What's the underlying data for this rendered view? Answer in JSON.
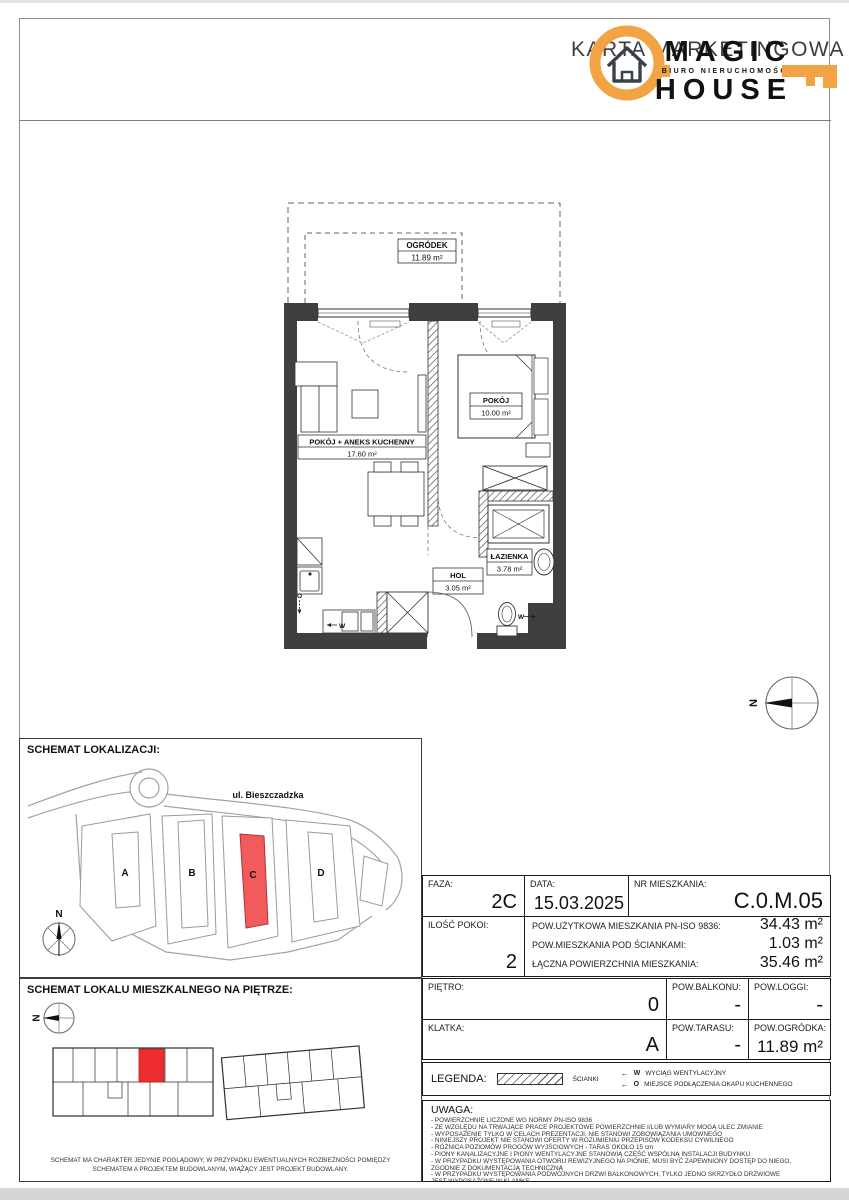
{
  "header": {
    "title": "KARTA MARKETINGOWA",
    "logo": {
      "magic": "MAGIC",
      "house": "HOUSE",
      "tagline": "BIURO NIERUCHOMOŚCI"
    }
  },
  "floorplan": {
    "garden": {
      "name": "OGRÓDEK",
      "area": "11.89 m²"
    },
    "living": {
      "name": "POKÓJ + ANEKS KUCHENNY",
      "area": "17.60 m²"
    },
    "bedroom": {
      "name": "POKÓJ",
      "area": "10.00 m²"
    },
    "hall": {
      "name": "HOL",
      "area": "3.05 m²"
    },
    "bathroom": {
      "name": "ŁAZIENKA",
      "area": "3.78 m²"
    },
    "markers": {
      "vent": "W",
      "hood": "O"
    },
    "compass": "N"
  },
  "location_schematic": {
    "title": "SCHEMAT LOKALIZACJI:",
    "street": "ul. Bieszczadzka",
    "buildings": [
      "A",
      "B",
      "C",
      "D"
    ],
    "highlighted": "C",
    "compass": "N"
  },
  "floor_schematic": {
    "title": "SCHEMAT LOKALU MIESZKALNEGO NA PIĘTRZE:",
    "compass": "N",
    "caption1": "SCHEMAT MA CHARAKTER JEDYNIE POGLĄDOWY, W PRZYPADKU EWENTUALNYCH ROZBIEŻNOŚCI POMIĘDZY",
    "caption2": "SCHEMATEM A PROJEKTEM BUDOWLANYM, WIĄŻĄCY JEST PROJEKT BUDOWLANY."
  },
  "details": {
    "faza": {
      "label": "FAZA:",
      "value": "2C"
    },
    "data": {
      "label": "DATA:",
      "value": "15.03.2025"
    },
    "nr": {
      "label": "NR MIESZKANIA:",
      "value": "C.0.M.05"
    },
    "rooms": {
      "label": "ILOŚĆ POKOI:",
      "value": "2"
    },
    "areas": [
      {
        "label": "POW.UŻYTKOWA MIESZKANIA PN-ISO 9836:",
        "value": "34.43 m²"
      },
      {
        "label": "POW.MIESZKANIA POD ŚCIANKAMI:",
        "value": "1.03 m²"
      },
      {
        "label": "ŁĄCZNA POWIERZCHNIA MIESZKANIA:",
        "value": "35.46 m²"
      }
    ],
    "pietro": {
      "label": "PIĘTRO:",
      "value": "0"
    },
    "balkon": {
      "label": "POW.BALKONU:",
      "value": "-"
    },
    "loggia": {
      "label": "POW.LOGGI:",
      "value": "-"
    },
    "klatka": {
      "label": "KLATKA:",
      "value": "A"
    },
    "taras": {
      "label": "POW.TARASU:",
      "value": "-"
    },
    "ogrodek": {
      "label": "POW.OGRÓDKA:",
      "value": "11.89 m²"
    }
  },
  "legend": {
    "label": "LEGENDA:",
    "walls": "ŚCIANKI",
    "vent_w": "W",
    "vent_w_desc": "WYCIĄG WENTYLACYJNY",
    "vent_o": "O",
    "vent_o_desc": "MIEJSCE PODŁĄCZENIA OKAPU KUCHENNEGO"
  },
  "uwaga": {
    "title": "UWAGA:",
    "lines": [
      "- POWIERZCHNIE LICZONE WG NORMY PN-ISO 9836",
      "- ZE WZGLĘDU NA TRWAJĄCE PRACE PROJEKTOWE POWIERZCHNIE I/LUB WYMIARY MOGĄ ULEC ZMIANIE",
      "- WYPOSAŻENIE TYLKO W CELACH PREZENTACJI, NIE STANOWI ZOBOWIĄZANIA UMOWNEGO",
      "- NINIEJSZY PROJEKT NIE STANOWI OFERTY W ROZUMIENIU PRZEPISÓW KODEKSU CYWILNEGO",
      "- RÓŻNICA POZIOMÓW PROGÓW WYJŚCIOWYCH - TARAS OKOŁO 15 cm",
      "- PIONY KANALIZACYJNE I PIONY WENTYLACYJNE STANOWIĄ CZĘŚĆ WSPÓLNĄ INSTALACJI BUDYNKU",
      "- W PRZYPADKU WYSTĘPOWANIA OTWORU REWIZYJNEGO NA PIONIE, MUSI BYĆ ZAPEWNIONY DOSTĘP DO NIEGO,",
      "ZGODNIE Z DOKUMENTACJĄ TECHNICZNĄ",
      "- W PRZYPADKU WYSTĘPOWANIA PODWÓJNYCH DRZWI BALKONOWYCH, TYLKO JEDNO SKRZYDŁO DRZWIOWE",
      "JEST WYPOSAŻONE W KLAMKĘ"
    ]
  },
  "colors": {
    "accent": "#F2A444",
    "highlight": "#F15B5B",
    "wall": "#3F3F3F",
    "logo_dark": "#3A4148"
  }
}
